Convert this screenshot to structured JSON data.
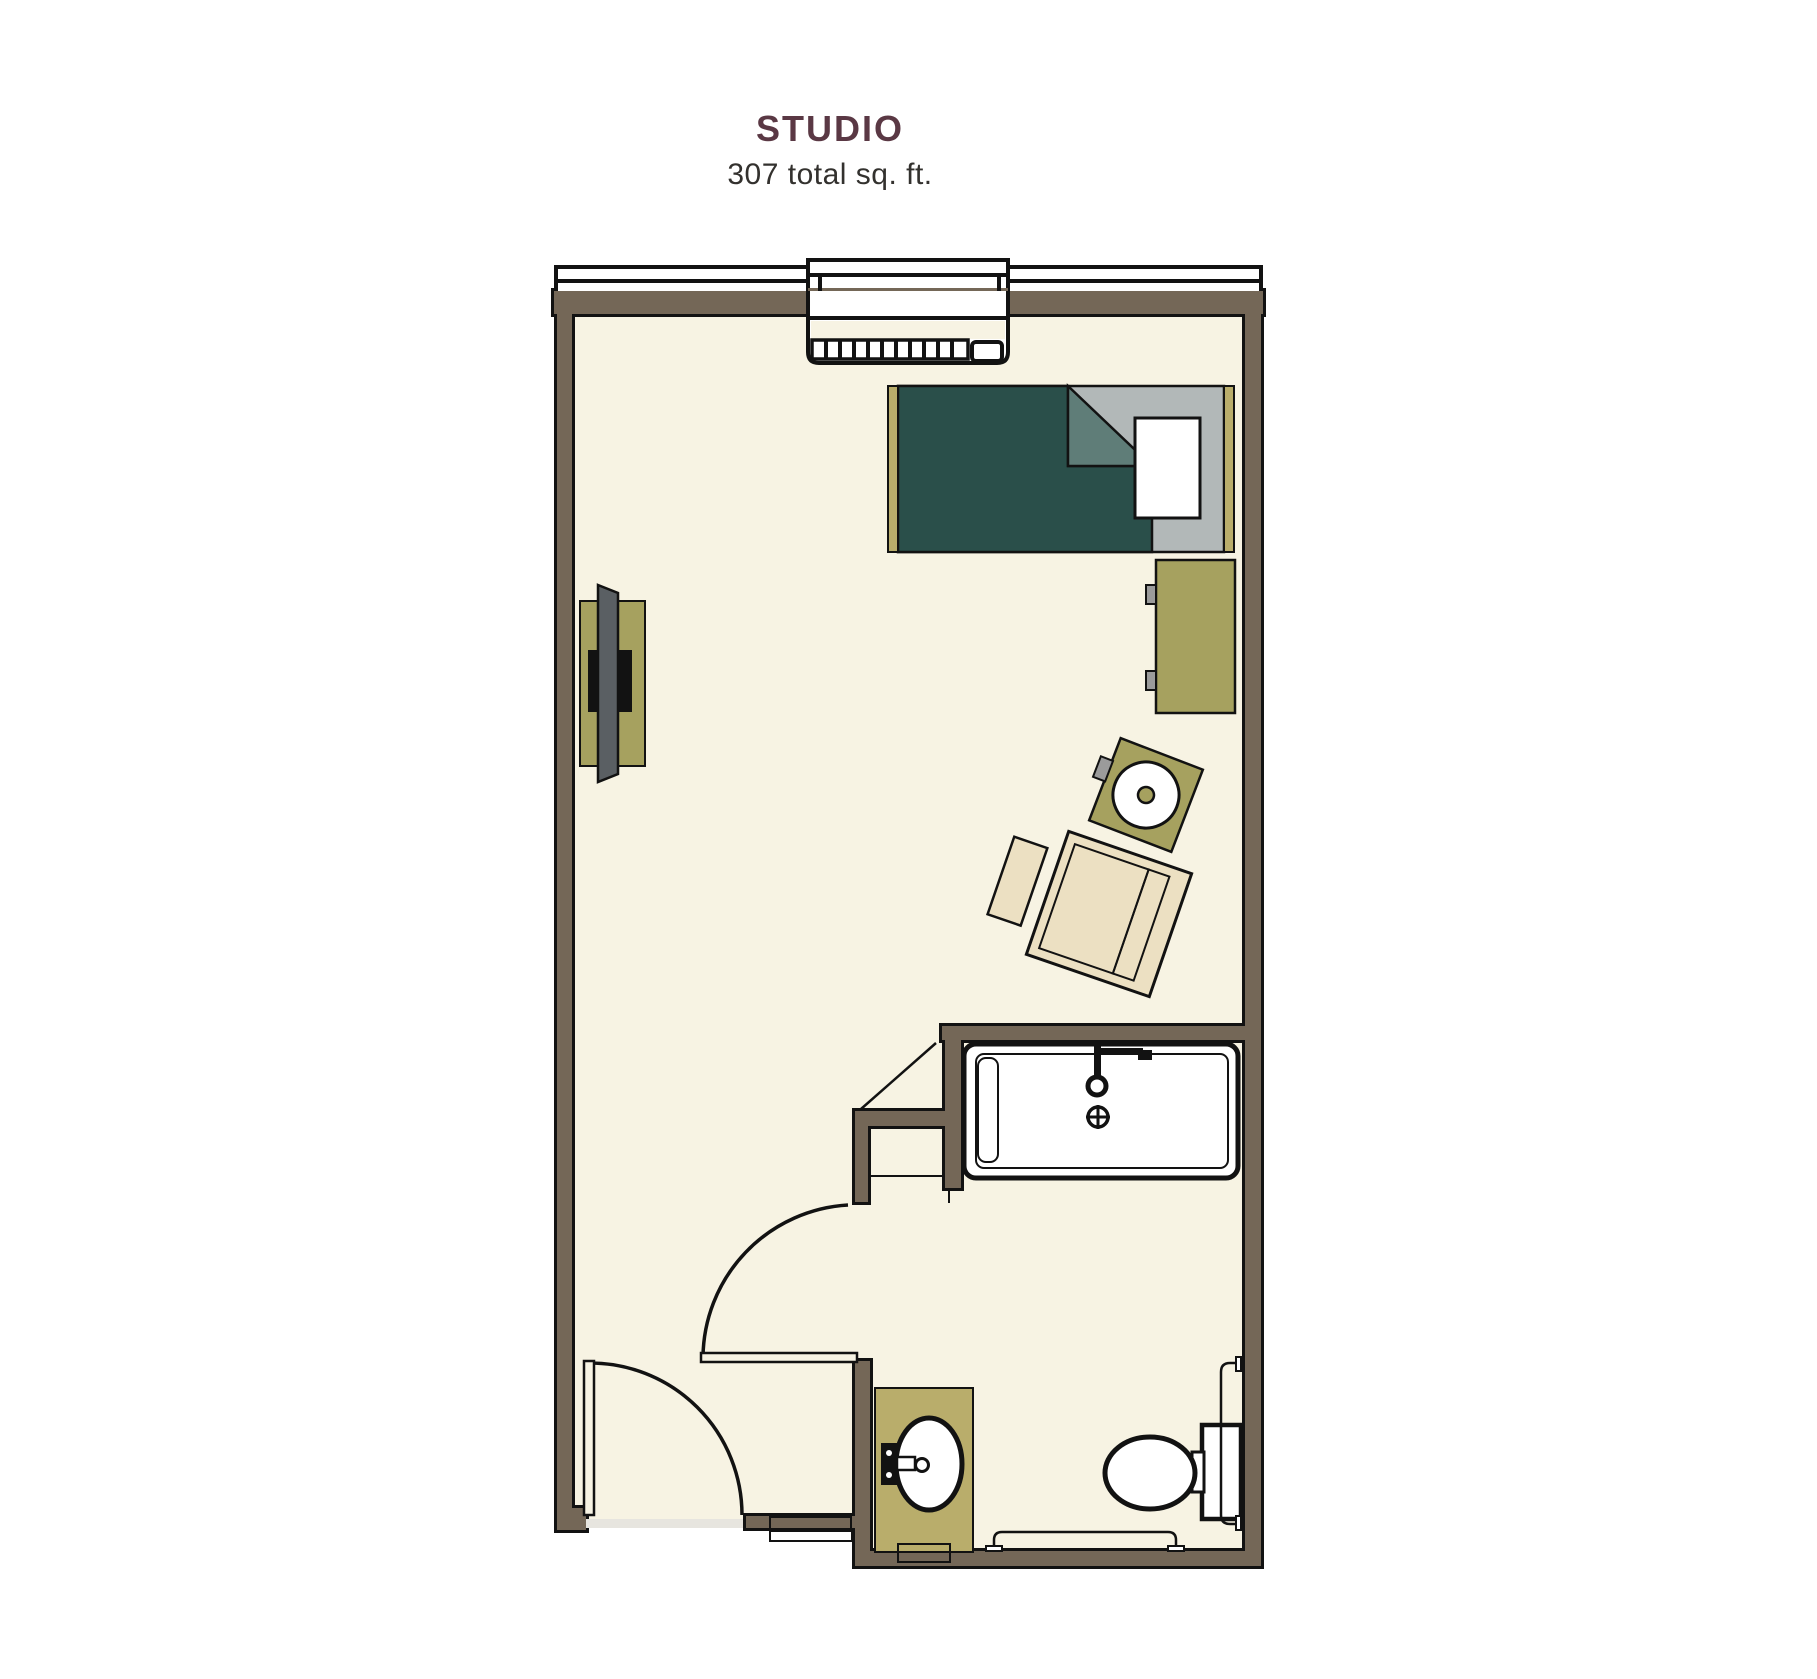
{
  "header": {
    "title": "STUDIO",
    "subtitle": "307 total sq. ft."
  },
  "palette": {
    "title_maroon": "#5a3844",
    "subtitle_ink": "#33312e",
    "wall": "#746757",
    "floor": "#f7f3e3",
    "outline": "#121212",
    "olive": "#a6a15f",
    "olive_light": "#b9ad6b",
    "teal": "#2a4f4a",
    "teal_fold": "#5f7d78",
    "mattress_gray": "#b2b8b8",
    "tv_gray": "#5a5f63",
    "knob_gray": "#9b9b9b",
    "threshold_gray": "#e7e5df",
    "paper": "#ffffff"
  },
  "floorplan": {
    "unit_type": "studio apartment",
    "fixtures": [
      "window-band",
      "ptac-heater-unit",
      "bed",
      "pillow",
      "dresser",
      "wall-tv",
      "media-console",
      "side-table",
      "armchair",
      "ottoman",
      "shower-tub",
      "shower-faucet",
      "shower-drain",
      "bathroom-door",
      "entry-door",
      "entry-threshold",
      "sink-vanity",
      "sink-faucet",
      "toilet",
      "grab-bar-vertical",
      "grab-bar-horizontal"
    ]
  }
}
